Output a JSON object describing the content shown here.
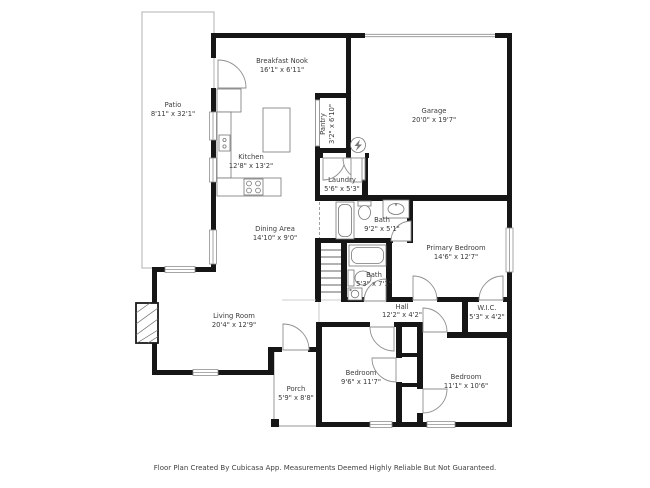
{
  "footer": {
    "disclaimer": "Floor Plan Created By Cubicasa App. Measurements Deemed Highly Reliable But Not Guaranteed."
  },
  "colors": {
    "wall": "#161616",
    "thin_line": "#8f8f8f",
    "fixture_line": "#777777",
    "text": "#3b3b3b",
    "patio_line": "#b8b8b8"
  },
  "rooms": {
    "patio": {
      "name": "Patio",
      "dims": "8'11\" x 32'1\""
    },
    "breakfast_nook": {
      "name": "Breakfast Nook",
      "dims": "16'1\" x 6'11\""
    },
    "kitchen": {
      "name": "Kitchen",
      "dims": "12'8\" x 13'2\""
    },
    "pantry": {
      "name": "Pantry",
      "dims": "3'2\" x 6'10\""
    },
    "garage": {
      "name": "Garage",
      "dims": "20'0\" x 19'7\""
    },
    "laundry": {
      "name": "Laundry",
      "dims": "5'6\" x 5'3\""
    },
    "bath_upper": {
      "name": "Bath",
      "dims": "9'2\" x 5'1\""
    },
    "bath_lower": {
      "name": "Bath",
      "dims": "5'3\" x 7'1\""
    },
    "dining": {
      "name": "Dining Area",
      "dims": "14'10\" x 9'0\""
    },
    "primary_bedroom": {
      "name": "Primary Bedroom",
      "dims": "14'6\" x 12'7\""
    },
    "living": {
      "name": "Living Room",
      "dims": "20'4\" x 12'9\""
    },
    "hall": {
      "name": "Hall",
      "dims": "12'2\" x 4'2\""
    },
    "wic": {
      "name": "W.I.C.",
      "dims": "5'3\" x 4'2\""
    },
    "porch": {
      "name": "Porch",
      "dims": "5'9\" x 8'8\""
    },
    "bedroom_left": {
      "name": "Bedroom",
      "dims": "9'6\" x 11'7\""
    },
    "bedroom_right": {
      "name": "Bedroom",
      "dims": "11'1\" x 10'6\""
    }
  }
}
